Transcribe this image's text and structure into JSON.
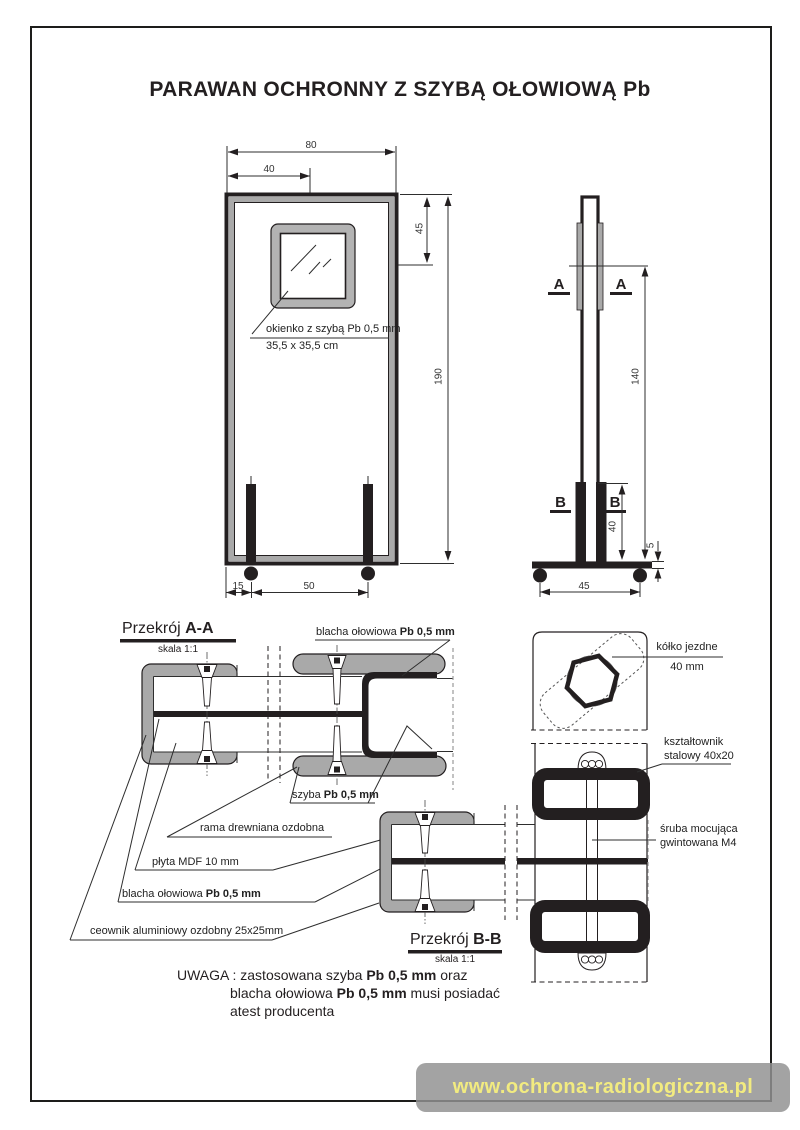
{
  "title": "PARAWAN OCHRONNY Z SZYBĄ OŁOWIOWĄ Pb",
  "front": {
    "dim_80": "80",
    "dim_40": "40",
    "dim_45": "45",
    "dim_190": "190",
    "dim_15": "15",
    "dim_50": "50",
    "window_label": "okienko z szybą Pb 0,5 mm",
    "window_size": "35,5 x 35,5 cm"
  },
  "side": {
    "marker_a": "A",
    "marker_b": "B",
    "dim_140": "140",
    "dim_40": "40",
    "dim_45": "45",
    "dim_5": "5"
  },
  "aa": {
    "heading": "Przekrój ",
    "code": "A-A",
    "scale": "skala 1:1",
    "lbl_blacha": "blacha ołowiowa ",
    "lbl_blacha_b": "Pb 0,5 mm",
    "lbl_szyba": "szyba ",
    "lbl_szyba_b": "Pb 0,5 mm",
    "lbl_rama": "rama drewniana ozdobna",
    "lbl_plyta": "płyta MDF 10 mm",
    "lbl_blacha2": "blacha ołowiowa ",
    "lbl_blacha2_b": "Pb 0,5 mm",
    "lbl_ceownik": "ceownik aluminiowy ozdobny 25x25mm"
  },
  "bb": {
    "heading": "Przekrój ",
    "code": "B-B",
    "scale": "skala 1:1"
  },
  "details": {
    "wheel_1": "kółko jezdne",
    "wheel_2": "40 mm",
    "profile_1": "kształtownik",
    "profile_2": "stalowy 40x20",
    "screw_1": "śruba mocująca",
    "screw_2": "gwintowana M4"
  },
  "note": {
    "l1a": "UWAGA : zastosowana szyba ",
    "l1b": "Pb 0,5 mm",
    "l1c": " oraz",
    "l2a": "blacha ołowiowa ",
    "l2b": "Pb 0,5 mm",
    "l2c": " musi posiadać",
    "l3": "atest producenta"
  },
  "footer_url": "www.ochrona-radiologiczna.pl",
  "colors": {
    "ink": "#231f20",
    "gray_fill": "#a9a9a9",
    "footer_text": "#f2eb80"
  }
}
